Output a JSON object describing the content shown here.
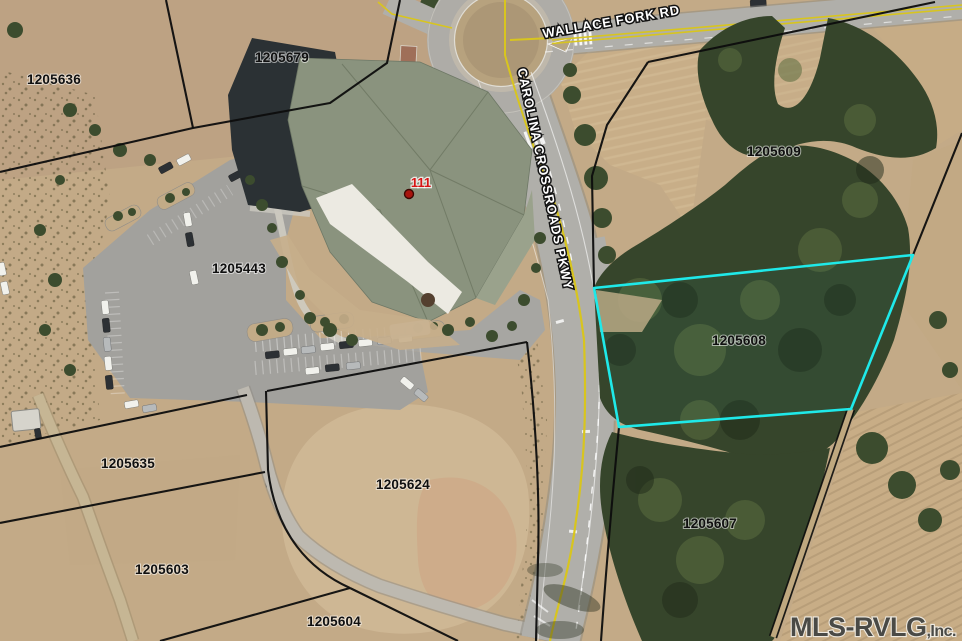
{
  "map": {
    "description": "Aerial MLS parcel map with highlighted lot",
    "watermark": {
      "main": "MLS-RVLG",
      "suffix": ",Inc."
    },
    "marker": {
      "label": "111",
      "color": "#d61414"
    },
    "roads": [
      {
        "name": "WALLACE FORK RD"
      },
      {
        "name": "CAROLINA CROSSROADS PKWY"
      }
    ],
    "parcels": [
      {
        "id": "1205636",
        "highlighted": false
      },
      {
        "id": "1205679",
        "highlighted": false
      },
      {
        "id": "1205443",
        "highlighted": false
      },
      {
        "id": "1205609",
        "highlighted": false
      },
      {
        "id": "1205608",
        "highlighted": true
      },
      {
        "id": "1205635",
        "highlighted": false
      },
      {
        "id": "1205624",
        "highlighted": false
      },
      {
        "id": "1205603",
        "highlighted": false
      },
      {
        "id": "1205604",
        "highlighted": false
      },
      {
        "id": "1205607",
        "highlighted": false
      }
    ],
    "colors": {
      "highlight_boundary": "#1fe9e9",
      "parcel_boundary": "#0d0d0d",
      "road_centerline_yellow": "#d8c51e",
      "field_tan": "#c3aa87",
      "forest_green": "#36452b"
    }
  }
}
